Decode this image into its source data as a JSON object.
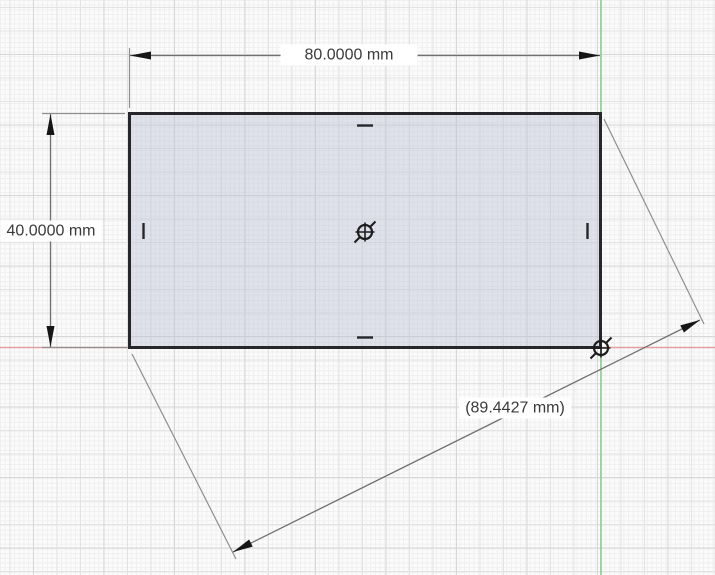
{
  "sketch": {
    "shape": "rectangle",
    "dimensions": [
      {
        "id": "width",
        "label": "80.0000 mm",
        "value": "80.0000",
        "unit": "mm",
        "type": "linear-horizontal"
      },
      {
        "id": "height",
        "label": "40.0000 mm",
        "value": "40.0000",
        "unit": "mm",
        "type": "linear-vertical"
      },
      {
        "id": "diagonal",
        "label": "(89.4427 mm)",
        "value": "89.4427",
        "unit": "mm",
        "type": "aligned-reference"
      }
    ],
    "constraints": {
      "midpoint_ticks": 4,
      "point_markers": [
        "rectangle-center-point",
        "origin-point"
      ]
    }
  },
  "colors": {
    "background": "#fbfbfb",
    "grid_minor": "#efefef",
    "grid_medium": "#e3e3e3",
    "grid_major": "#d6d6d6",
    "x_axis": "#e2a0a0",
    "y_axis": "#8fc98f",
    "shape_fill": "#bcc2d6",
    "shape_stroke": "#26262b",
    "dimension_line": "#6f6f6f",
    "extension_line": "#8f8f8f",
    "arrowhead": "#161616",
    "label_text": "#3a3a3a",
    "label_bg": "#ffffff"
  }
}
